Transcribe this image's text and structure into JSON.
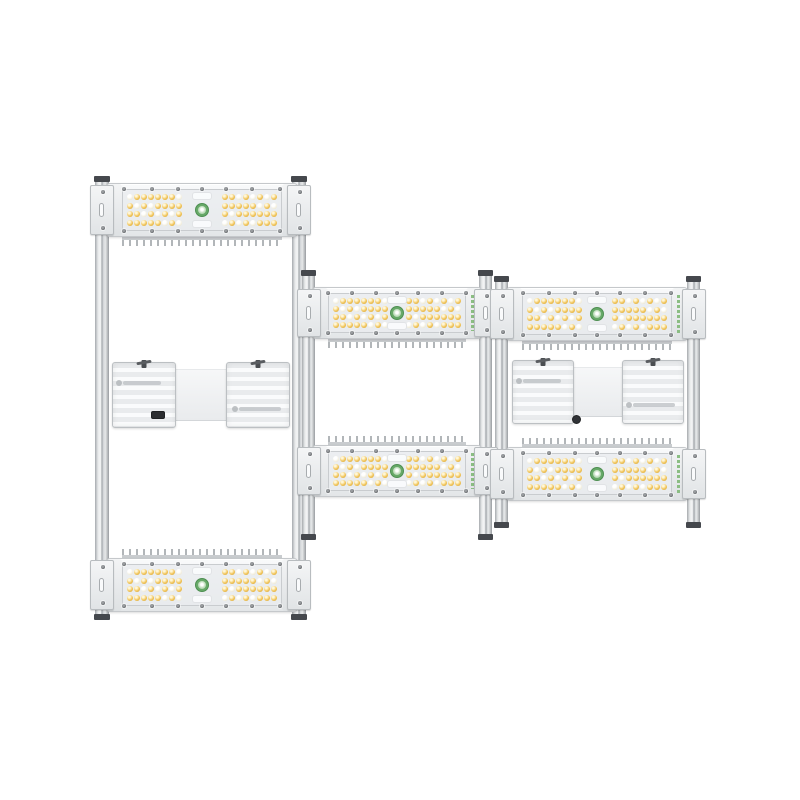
{
  "scene": {
    "type": "product-photo",
    "subject": "Three modular LED grow light bar fixtures mounted on aluminum rails",
    "background_color": "#ffffff"
  },
  "colors": {
    "rail_body": "#d9dbde",
    "rail_cap": "#45484d",
    "panel_body": "#f2f3f4",
    "panel_border": "#c5c8cb",
    "lens": "#e9ecee",
    "led_warm": "#f2c65c",
    "led_cool": "#f1ecd9",
    "screw": "#4b4e52",
    "logo_green": "#67a968",
    "brand_green": "#86bb7d",
    "fin_gray": "#b2b6b9",
    "driver_plate": "#eceef0",
    "port_black": "#2b2d30"
  },
  "panel_spec": {
    "led_rows": 4,
    "led_cols": 8,
    "led_arrays_per_panel": 2,
    "leds_per_panel": 64,
    "led_types": [
      "warm-white",
      "cool-white"
    ],
    "center_logo_icon": "sprout-logo",
    "edge_screws_per_side": 7
  },
  "fixtures": [
    {
      "name": "fixture-left",
      "description": "tall fixture: top panel, mid driver, bottom panel",
      "rails": [
        {
          "x": 95,
          "y": 178,
          "w": 14,
          "h": 440
        },
        {
          "x": 292,
          "y": 178,
          "w": 14,
          "h": 440
        }
      ],
      "panels": [
        {
          "x": 106,
          "y": 183,
          "w": 192,
          "h": 54,
          "fins": "bottom"
        },
        {
          "x": 106,
          "y": 558,
          "w": 192,
          "h": 54,
          "fins": "top"
        }
      ],
      "driver": {
        "x": 112,
        "y": 362,
        "w": 178,
        "h": 66,
        "port": "left-plate"
      }
    },
    {
      "name": "fixture-middle",
      "description": "two panels, driver hidden",
      "rails": [
        {
          "x": 302,
          "y": 272,
          "w": 13,
          "h": 266
        },
        {
          "x": 479,
          "y": 272,
          "w": 13,
          "h": 266
        }
      ],
      "panels": [
        {
          "x": 312,
          "y": 287,
          "w": 170,
          "h": 52,
          "fins": "bottom"
        },
        {
          "x": 312,
          "y": 445,
          "w": 170,
          "h": 52,
          "fins": "top"
        }
      ],
      "driver": null
    },
    {
      "name": "fixture-right",
      "description": "two panels with mid driver",
      "rails": [
        {
          "x": 495,
          "y": 278,
          "w": 13,
          "h": 248
        },
        {
          "x": 687,
          "y": 278,
          "w": 13,
          "h": 248
        }
      ],
      "panels": [
        {
          "x": 506,
          "y": 287,
          "w": 182,
          "h": 54,
          "fins": "bottom"
        },
        {
          "x": 506,
          "y": 447,
          "w": 182,
          "h": 54,
          "fins": "top"
        }
      ],
      "driver": {
        "x": 512,
        "y": 360,
        "w": 172,
        "h": 64,
        "port": "center"
      }
    }
  ]
}
